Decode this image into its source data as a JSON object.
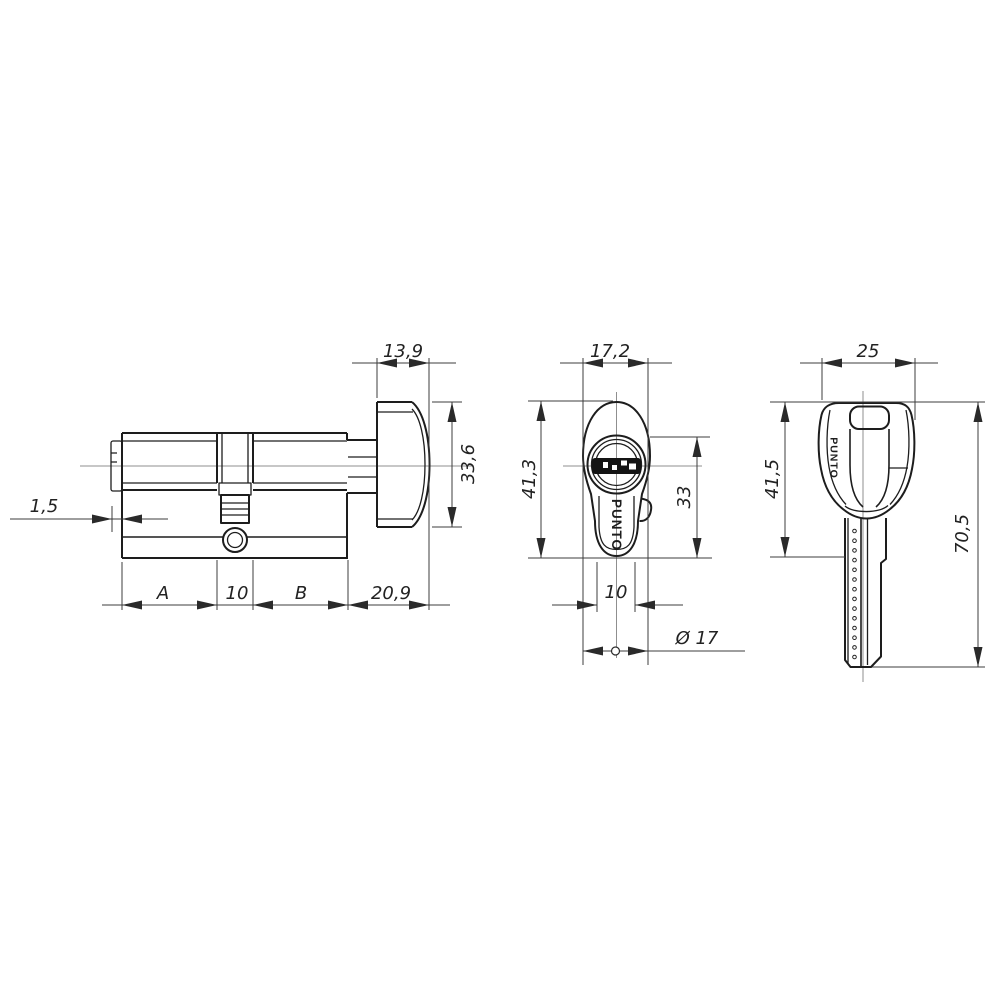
{
  "drawing": {
    "background": "#ffffff",
    "line_color": "#1d1d1d",
    "dim_color": "#3c3c3c",
    "centerline_color": "#8f8f8f",
    "side_view": {
      "dim_front_rim": "1,5",
      "dim_knob_depth": "13,9",
      "dim_knob_diameter": "33,6",
      "dim_a": "A",
      "dim_cam_width": "10",
      "dim_b": "B",
      "dim_knob_length": "20,9"
    },
    "front_view": {
      "dim_face_width": "17,2",
      "dim_face_height": "41,3",
      "dim_body_height": "33",
      "dim_body_width": "10",
      "dim_plug_diameter": "Ø 17",
      "brand": "PUNTO"
    },
    "key_view": {
      "dim_head_width": "25",
      "dim_head_height": "41,5",
      "dim_total_length": "70,5",
      "brand": "PUNTO"
    }
  }
}
